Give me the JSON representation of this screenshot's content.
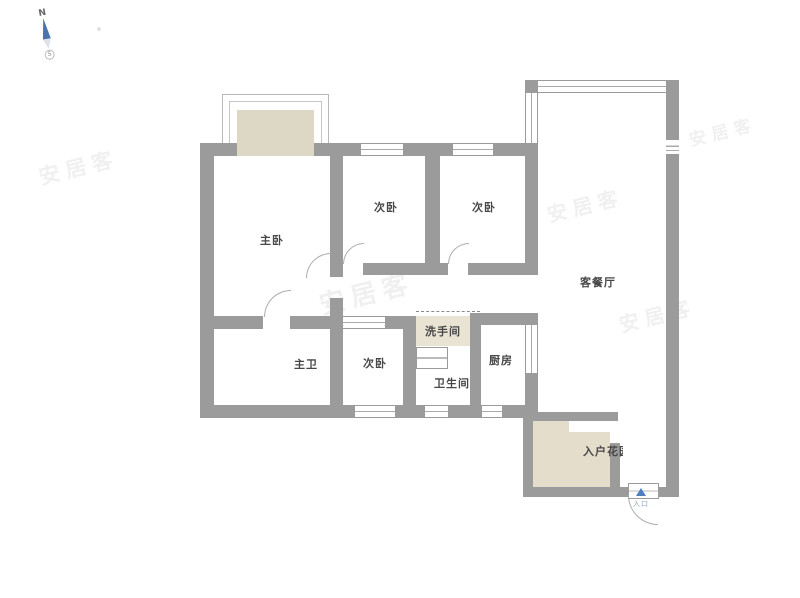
{
  "compass": {
    "north": "N",
    "south": "S"
  },
  "rooms": [
    {
      "name": "master-bedroom",
      "label": "主卧"
    },
    {
      "name": "bedroom-top-mid",
      "label": "次卧"
    },
    {
      "name": "bedroom-top-right",
      "label": "次卧"
    },
    {
      "name": "living-dining",
      "label": "客餐厅"
    },
    {
      "name": "master-bath",
      "label": "主卫"
    },
    {
      "name": "bedroom-bottom",
      "label": "次卧"
    },
    {
      "name": "washroom",
      "label": "洗手间"
    },
    {
      "name": "bathroom",
      "label": "卫生间"
    },
    {
      "name": "kitchen",
      "label": "厨房"
    },
    {
      "name": "entry-garden",
      "label": "入户花园"
    }
  ],
  "entrance": {
    "label": "入口"
  },
  "watermark": {
    "text": "安居客"
  },
  "colors": {
    "wall": "#9b9b9b",
    "beige": "#e4ddcc",
    "accent_blue": "#4f7fbf"
  }
}
